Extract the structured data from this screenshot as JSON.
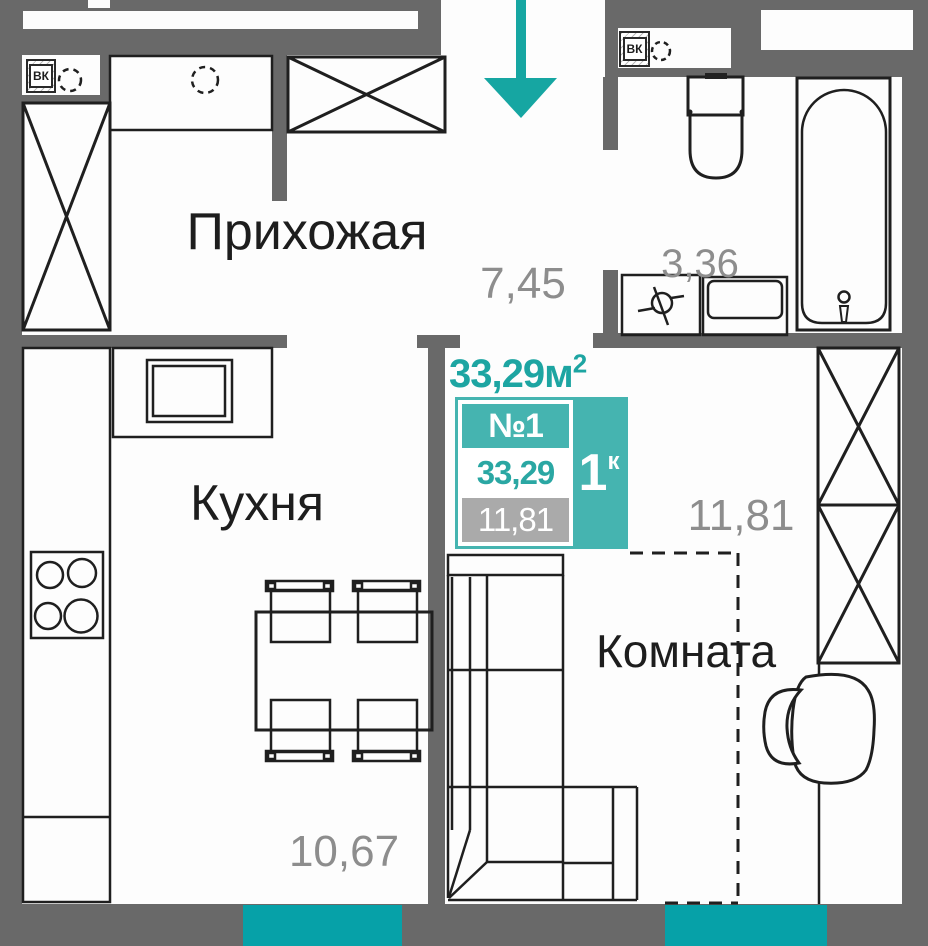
{
  "plan": {
    "hallway_label": "Прихожая",
    "hallway_area": "7,45",
    "bathroom_area": "3,36",
    "kitchen_label": "Кухня",
    "kitchen_area": "10,67",
    "room_label": "Комната",
    "room_area": "11,81"
  },
  "badge": {
    "total_area": "33,29",
    "total_area_unit": "м",
    "total_area_sup": "2",
    "flat_number": "№1",
    "area_value": "33,29",
    "living_area": "11,81",
    "rooms_count": "1",
    "rooms_suffix": "к"
  },
  "vents": {
    "hallway": "ВК",
    "bathroom": "ВК"
  },
  "colors": {
    "wall_gray": "#696969",
    "line_black": "#1f1f1f",
    "accent_teal": "#1da5a2",
    "badge_teal": "#45b4b0",
    "window_teal": "#06a1a8",
    "area_text_gray": "#8d8d8d",
    "living_row_gray": "#aaaaaa"
  }
}
